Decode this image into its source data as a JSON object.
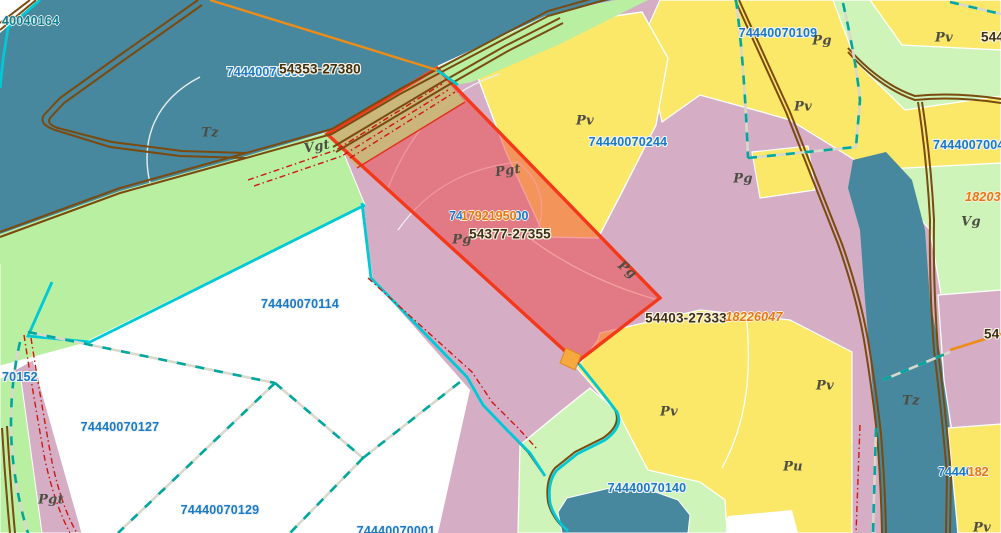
{
  "map": {
    "kind": "cadastral-parcel-map",
    "highlighted_parcel_survey_number": "54377-27355"
  },
  "colors": {
    "water": "#47889f",
    "field_yellow": "#fbe768",
    "grass_green": "#b9efa1",
    "grass_green_light": "#cef4ba",
    "pasture_mauve": "#d5aec6",
    "white_area": "#ffffff",
    "highlight_red_outline": "#f4391b",
    "road_strip_tan": "#c9ba7b",
    "road_brown": "#7a4a0f",
    "line_cyan": "#00c9d6",
    "boundary_teal_dash": "#00a79f",
    "line_orange": "#ee8c16",
    "red_dash": "#cf1610",
    "parcel_number_blue": "#1b79c4",
    "survey_number_dark": "#3f2f10",
    "utility_number_orange": "#e57717",
    "water_number_teal": "#0d7e8f",
    "soil_label_gray": "#4e4e44"
  },
  "labels": [
    {
      "text": "40040164",
      "kind": "water-object-number"
    },
    {
      "text": "74440070099",
      "kind": "parcel-number"
    },
    {
      "text": "54353-27380",
      "kind": "survey-number"
    },
    {
      "text": "Tz",
      "kind": "soil-code"
    },
    {
      "text": "Vgt",
      "kind": "soil-code"
    },
    {
      "text": "Pv",
      "kind": "soil-code"
    },
    {
      "text": "74440070244",
      "kind": "parcel-number"
    },
    {
      "text": "Pgt",
      "kind": "soil-code"
    },
    {
      "text": "Pg",
      "kind": "soil-code"
    },
    {
      "text": "74",
      "kind": "parcel-number-fragment"
    },
    {
      "text": "17921950",
      "kind": "utility-number"
    },
    {
      "text": "00",
      "kind": "parcel-number-fragment"
    },
    {
      "text": "54377-27355",
      "kind": "survey-number"
    },
    {
      "text": "Pg",
      "kind": "soil-code"
    },
    {
      "text": "Pg",
      "kind": "soil-code"
    },
    {
      "text": "54403-27333",
      "kind": "survey-number"
    },
    {
      "text": "18226047",
      "kind": "utility-number"
    },
    {
      "text": "74440070114",
      "kind": "parcel-number"
    },
    {
      "text": "70152",
      "kind": "parcel-number"
    },
    {
      "text": "74440070127",
      "kind": "parcel-number"
    },
    {
      "text": "Pgt",
      "kind": "soil-code"
    },
    {
      "text": "74440070129",
      "kind": "parcel-number"
    },
    {
      "text": "74440070001",
      "kind": "parcel-number"
    },
    {
      "text": "74440070140",
      "kind": "parcel-number"
    },
    {
      "text": "Pv",
      "kind": "soil-code"
    },
    {
      "text": "Pv",
      "kind": "soil-code"
    },
    {
      "text": "Pu",
      "kind": "soil-code"
    },
    {
      "text": "74440070109",
      "kind": "parcel-number"
    },
    {
      "text": "Pg",
      "kind": "soil-code"
    },
    {
      "text": "Pv",
      "kind": "soil-code"
    },
    {
      "text": "Pv",
      "kind": "soil-code"
    },
    {
      "text": "544",
      "kind": "survey-number"
    },
    {
      "text": "74440070041",
      "kind": "parcel-number"
    },
    {
      "text": "1820395",
      "kind": "utility-number"
    },
    {
      "text": "Vg",
      "kind": "soil-code"
    },
    {
      "text": "Tz",
      "kind": "soil-code"
    },
    {
      "text": "54",
      "kind": "survey-number"
    },
    {
      "text": "74440",
      "kind": "parcel-number-fragment"
    },
    {
      "text": "182",
      "kind": "utility-number-fragment"
    },
    {
      "text": "Pv",
      "kind": "soil-code"
    }
  ]
}
